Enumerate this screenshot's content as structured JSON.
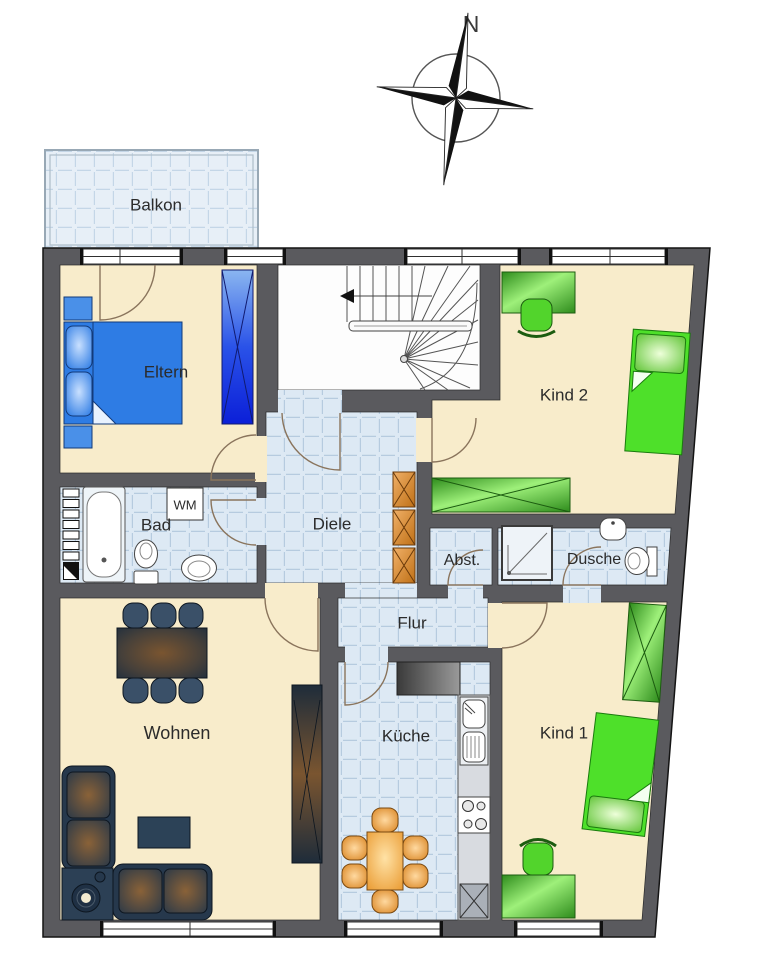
{
  "compass": {
    "north_label": "N"
  },
  "rooms": {
    "balkon": {
      "label": "Balkon"
    },
    "eltern": {
      "label": "Eltern"
    },
    "kind2": {
      "label": "Kind 2"
    },
    "bad": {
      "label": "Bad"
    },
    "diele": {
      "label": "Diele"
    },
    "abstellraum": {
      "label": "Abst."
    },
    "dusche": {
      "label": "Dusche"
    },
    "flur": {
      "label": "Flur"
    },
    "wohnen": {
      "label": "Wohnen"
    },
    "kueche": {
      "label": "Küche"
    },
    "kind1": {
      "label": "Kind 1"
    }
  },
  "appliances": {
    "washing_machine": {
      "label": "WM"
    }
  },
  "colors": {
    "wall": "#5a5a5e",
    "floor_cream": "#f8eccb",
    "floor_tile": "#dde9f4",
    "tile_line": "#b6cbdf",
    "balcony_tile": "#e7eff7",
    "furniture_blue": "#2e7ce4",
    "furniture_green": "#4ee02a",
    "furniture_orange": "#eda24d",
    "furniture_dark_navy": "#26384c",
    "counter_gray": "#8a8a8a",
    "stair_floor": "#fdfdfd"
  }
}
